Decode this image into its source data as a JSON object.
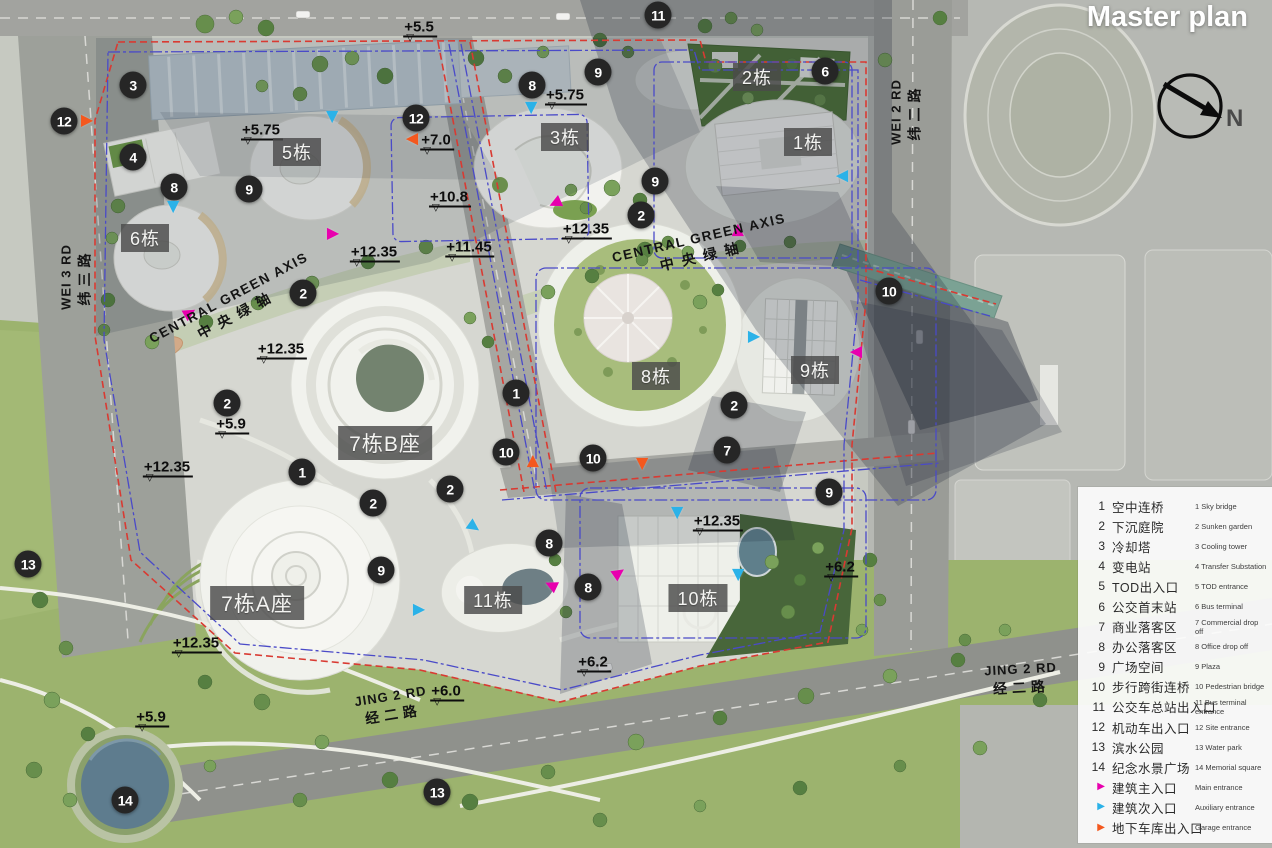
{
  "title": "Master plan",
  "north": {
    "label": "N"
  },
  "colors": {
    "main_entrance": "#e800ae",
    "aux_entrance": "#2bb2e8",
    "garage_entrance": "#f4581e",
    "marker_bg": "#262626",
    "red_boundary": "#d93a32",
    "blue_boundary": "#4a4ac8"
  },
  "legend": {
    "items": [
      {
        "num": "1",
        "cn": "空中连桥",
        "en": "1 Sky bridge"
      },
      {
        "num": "2",
        "cn": "下沉庭院",
        "en": "2 Sunken garden"
      },
      {
        "num": "3",
        "cn": "冷却塔",
        "en": "3 Cooling tower"
      },
      {
        "num": "4",
        "cn": "变电站",
        "en": "4 Transfer Substation"
      },
      {
        "num": "5",
        "cn": "TOD出入口",
        "en": "5 TOD entrance"
      },
      {
        "num": "6",
        "cn": "公交首末站",
        "en": "6 Bus terminal"
      },
      {
        "num": "7",
        "cn": "商业落客区",
        "en": "7 Commercial drop off"
      },
      {
        "num": "8",
        "cn": "办公落客区",
        "en": "8 Office drop off"
      },
      {
        "num": "9",
        "cn": "广场空间",
        "en": "9 Plaza"
      },
      {
        "num": "10",
        "cn": "步行跨街连桥",
        "en": "10 Pedestrian bridge"
      },
      {
        "num": "11",
        "cn": "公交车总站出入口",
        "en": "11 Bus terminal entrance"
      },
      {
        "num": "12",
        "cn": "机动车出入口",
        "en": "12 Site entrance"
      },
      {
        "num": "13",
        "cn": "滨水公园",
        "en": "13 Water park"
      },
      {
        "num": "14",
        "cn": "纪念水景广场",
        "en": "14 Memorial square"
      }
    ],
    "arrows": [
      {
        "type": "main",
        "cn": "建筑主入口",
        "en": "Main entrance"
      },
      {
        "type": "aux",
        "cn": "建筑次入口",
        "en": "Auxiliary entrance"
      },
      {
        "type": "garage",
        "cn": "地下车库出入口",
        "en": "Garage entrance"
      }
    ]
  },
  "buildings": [
    {
      "t": "1栋",
      "x": 808,
      "y": 142
    },
    {
      "t": "2栋",
      "x": 757,
      "y": 77
    },
    {
      "t": "3栋",
      "x": 565,
      "y": 137
    },
    {
      "t": "5栋",
      "x": 297,
      "y": 152
    },
    {
      "t": "6栋",
      "x": 145,
      "y": 238
    },
    {
      "t": "8栋",
      "x": 656,
      "y": 376
    },
    {
      "t": "9栋",
      "x": 815,
      "y": 370
    },
    {
      "t": "7栋B座",
      "x": 385,
      "y": 443
    },
    {
      "t": "7栋A座",
      "x": 257,
      "y": 603
    },
    {
      "t": "10栋",
      "x": 698,
      "y": 598
    },
    {
      "t": "11栋",
      "x": 493,
      "y": 600
    }
  ],
  "markers": [
    {
      "n": "11",
      "x": 658,
      "y": 15
    },
    {
      "n": "3",
      "x": 133,
      "y": 85
    },
    {
      "n": "8",
      "x": 532,
      "y": 85
    },
    {
      "n": "9",
      "x": 598,
      "y": 72
    },
    {
      "n": "6",
      "x": 825,
      "y": 71
    },
    {
      "n": "12",
      "x": 64,
      "y": 121
    },
    {
      "n": "12",
      "x": 416,
      "y": 118
    },
    {
      "n": "4",
      "x": 133,
      "y": 157
    },
    {
      "n": "8",
      "x": 174,
      "y": 187
    },
    {
      "n": "9",
      "x": 249,
      "y": 189
    },
    {
      "n": "9",
      "x": 655,
      "y": 181
    },
    {
      "n": "2",
      "x": 641,
      "y": 215
    },
    {
      "n": "10",
      "x": 889,
      "y": 291
    },
    {
      "n": "2",
      "x": 303,
      "y": 293
    },
    {
      "n": "2",
      "x": 227,
      "y": 403
    },
    {
      "n": "1",
      "x": 516,
      "y": 393
    },
    {
      "n": "2",
      "x": 734,
      "y": 405
    },
    {
      "n": "7",
      "x": 727,
      "y": 450
    },
    {
      "n": "10",
      "x": 506,
      "y": 452
    },
    {
      "n": "10",
      "x": 593,
      "y": 458
    },
    {
      "n": "1",
      "x": 302,
      "y": 472
    },
    {
      "n": "2",
      "x": 450,
      "y": 489
    },
    {
      "n": "9",
      "x": 829,
      "y": 492
    },
    {
      "n": "2",
      "x": 373,
      "y": 503
    },
    {
      "n": "8",
      "x": 549,
      "y": 543
    },
    {
      "n": "13",
      "x": 28,
      "y": 564
    },
    {
      "n": "9",
      "x": 381,
      "y": 570
    },
    {
      "n": "8",
      "x": 588,
      "y": 587
    },
    {
      "n": "13",
      "x": 437,
      "y": 792
    },
    {
      "n": "14",
      "x": 125,
      "y": 800
    }
  ],
  "elevations": [
    {
      "t": "+5.5",
      "x": 420,
      "y": 27
    },
    {
      "t": "+5.75",
      "x": 566,
      "y": 95
    },
    {
      "t": "+5.75",
      "x": 262,
      "y": 130
    },
    {
      "t": "+7.0",
      "x": 437,
      "y": 140
    },
    {
      "t": "+10.8",
      "x": 450,
      "y": 197
    },
    {
      "t": "+12.35",
      "x": 587,
      "y": 229
    },
    {
      "t": "+11.45",
      "x": 470,
      "y": 247
    },
    {
      "t": "+12.35",
      "x": 375,
      "y": 252
    },
    {
      "t": "+12.35",
      "x": 282,
      "y": 349
    },
    {
      "t": "+5.9",
      "x": 232,
      "y": 424
    },
    {
      "t": "+12.35",
      "x": 168,
      "y": 467
    },
    {
      "t": "+12.35",
      "x": 718,
      "y": 521
    },
    {
      "t": "+6.2",
      "x": 841,
      "y": 567
    },
    {
      "t": "+12.35",
      "x": 197,
      "y": 643
    },
    {
      "t": "+6.2",
      "x": 594,
      "y": 662
    },
    {
      "t": "+6.0",
      "x": 447,
      "y": 691
    },
    {
      "t": "+5.9",
      "x": 152,
      "y": 717
    }
  ],
  "entrances": [
    {
      "type": "garage",
      "x": 87,
      "y": 121,
      "r": 0
    },
    {
      "type": "garage",
      "x": 412,
      "y": 139,
      "r": 180
    },
    {
      "type": "garage",
      "x": 533,
      "y": 461,
      "r": -90
    },
    {
      "type": "garage",
      "x": 642,
      "y": 464,
      "r": 90
    },
    {
      "type": "aux",
      "x": 332,
      "y": 117,
      "r": 90
    },
    {
      "type": "aux",
      "x": 531,
      "y": 108,
      "r": 90
    },
    {
      "type": "aux",
      "x": 173,
      "y": 207,
      "r": 90
    },
    {
      "type": "aux",
      "x": 842,
      "y": 176,
      "r": 180
    },
    {
      "type": "aux",
      "x": 754,
      "y": 337,
      "r": 0
    },
    {
      "type": "aux",
      "x": 677,
      "y": 513,
      "r": 90
    },
    {
      "type": "aux",
      "x": 738,
      "y": 575,
      "r": 90
    },
    {
      "type": "aux",
      "x": 474,
      "y": 527,
      "r": 35
    },
    {
      "type": "aux",
      "x": 419,
      "y": 610,
      "r": 0
    },
    {
      "type": "main",
      "x": 333,
      "y": 234,
      "r": 0
    },
    {
      "type": "main",
      "x": 555,
      "y": 203,
      "r": 155
    },
    {
      "type": "main",
      "x": 738,
      "y": 230,
      "r": -90
    },
    {
      "type": "main",
      "x": 190,
      "y": 313,
      "r": -30
    },
    {
      "type": "main",
      "x": 856,
      "y": 352,
      "r": 180
    },
    {
      "type": "main",
      "x": 619,
      "y": 573,
      "r": -35
    },
    {
      "type": "main",
      "x": 551,
      "y": 585,
      "r": 205
    }
  ],
  "roads": [
    {
      "en": "WEI 3 RD",
      "cn": "纬三路",
      "x": 76,
      "y": 277,
      "rot": -90
    },
    {
      "en": "WEI 2 RD",
      "cn": "纬二路",
      "x": 906,
      "y": 112,
      "rot": -90
    },
    {
      "en": "JING 2 RD",
      "cn": "经二路",
      "x": 392,
      "y": 706,
      "rot": -9
    },
    {
      "en": "JING 2 RD",
      "cn": "经二路",
      "x": 1021,
      "y": 679,
      "rot": -3
    }
  ],
  "axes": [
    {
      "en": "CENTRAL GREEN AXIS",
      "cn": "中央绿轴",
      "x": 233,
      "y": 306,
      "rot": -28
    },
    {
      "en": "CENTRAL GREEN AXIS",
      "cn": "中央绿轴",
      "x": 701,
      "y": 247,
      "rot": -13
    }
  ]
}
